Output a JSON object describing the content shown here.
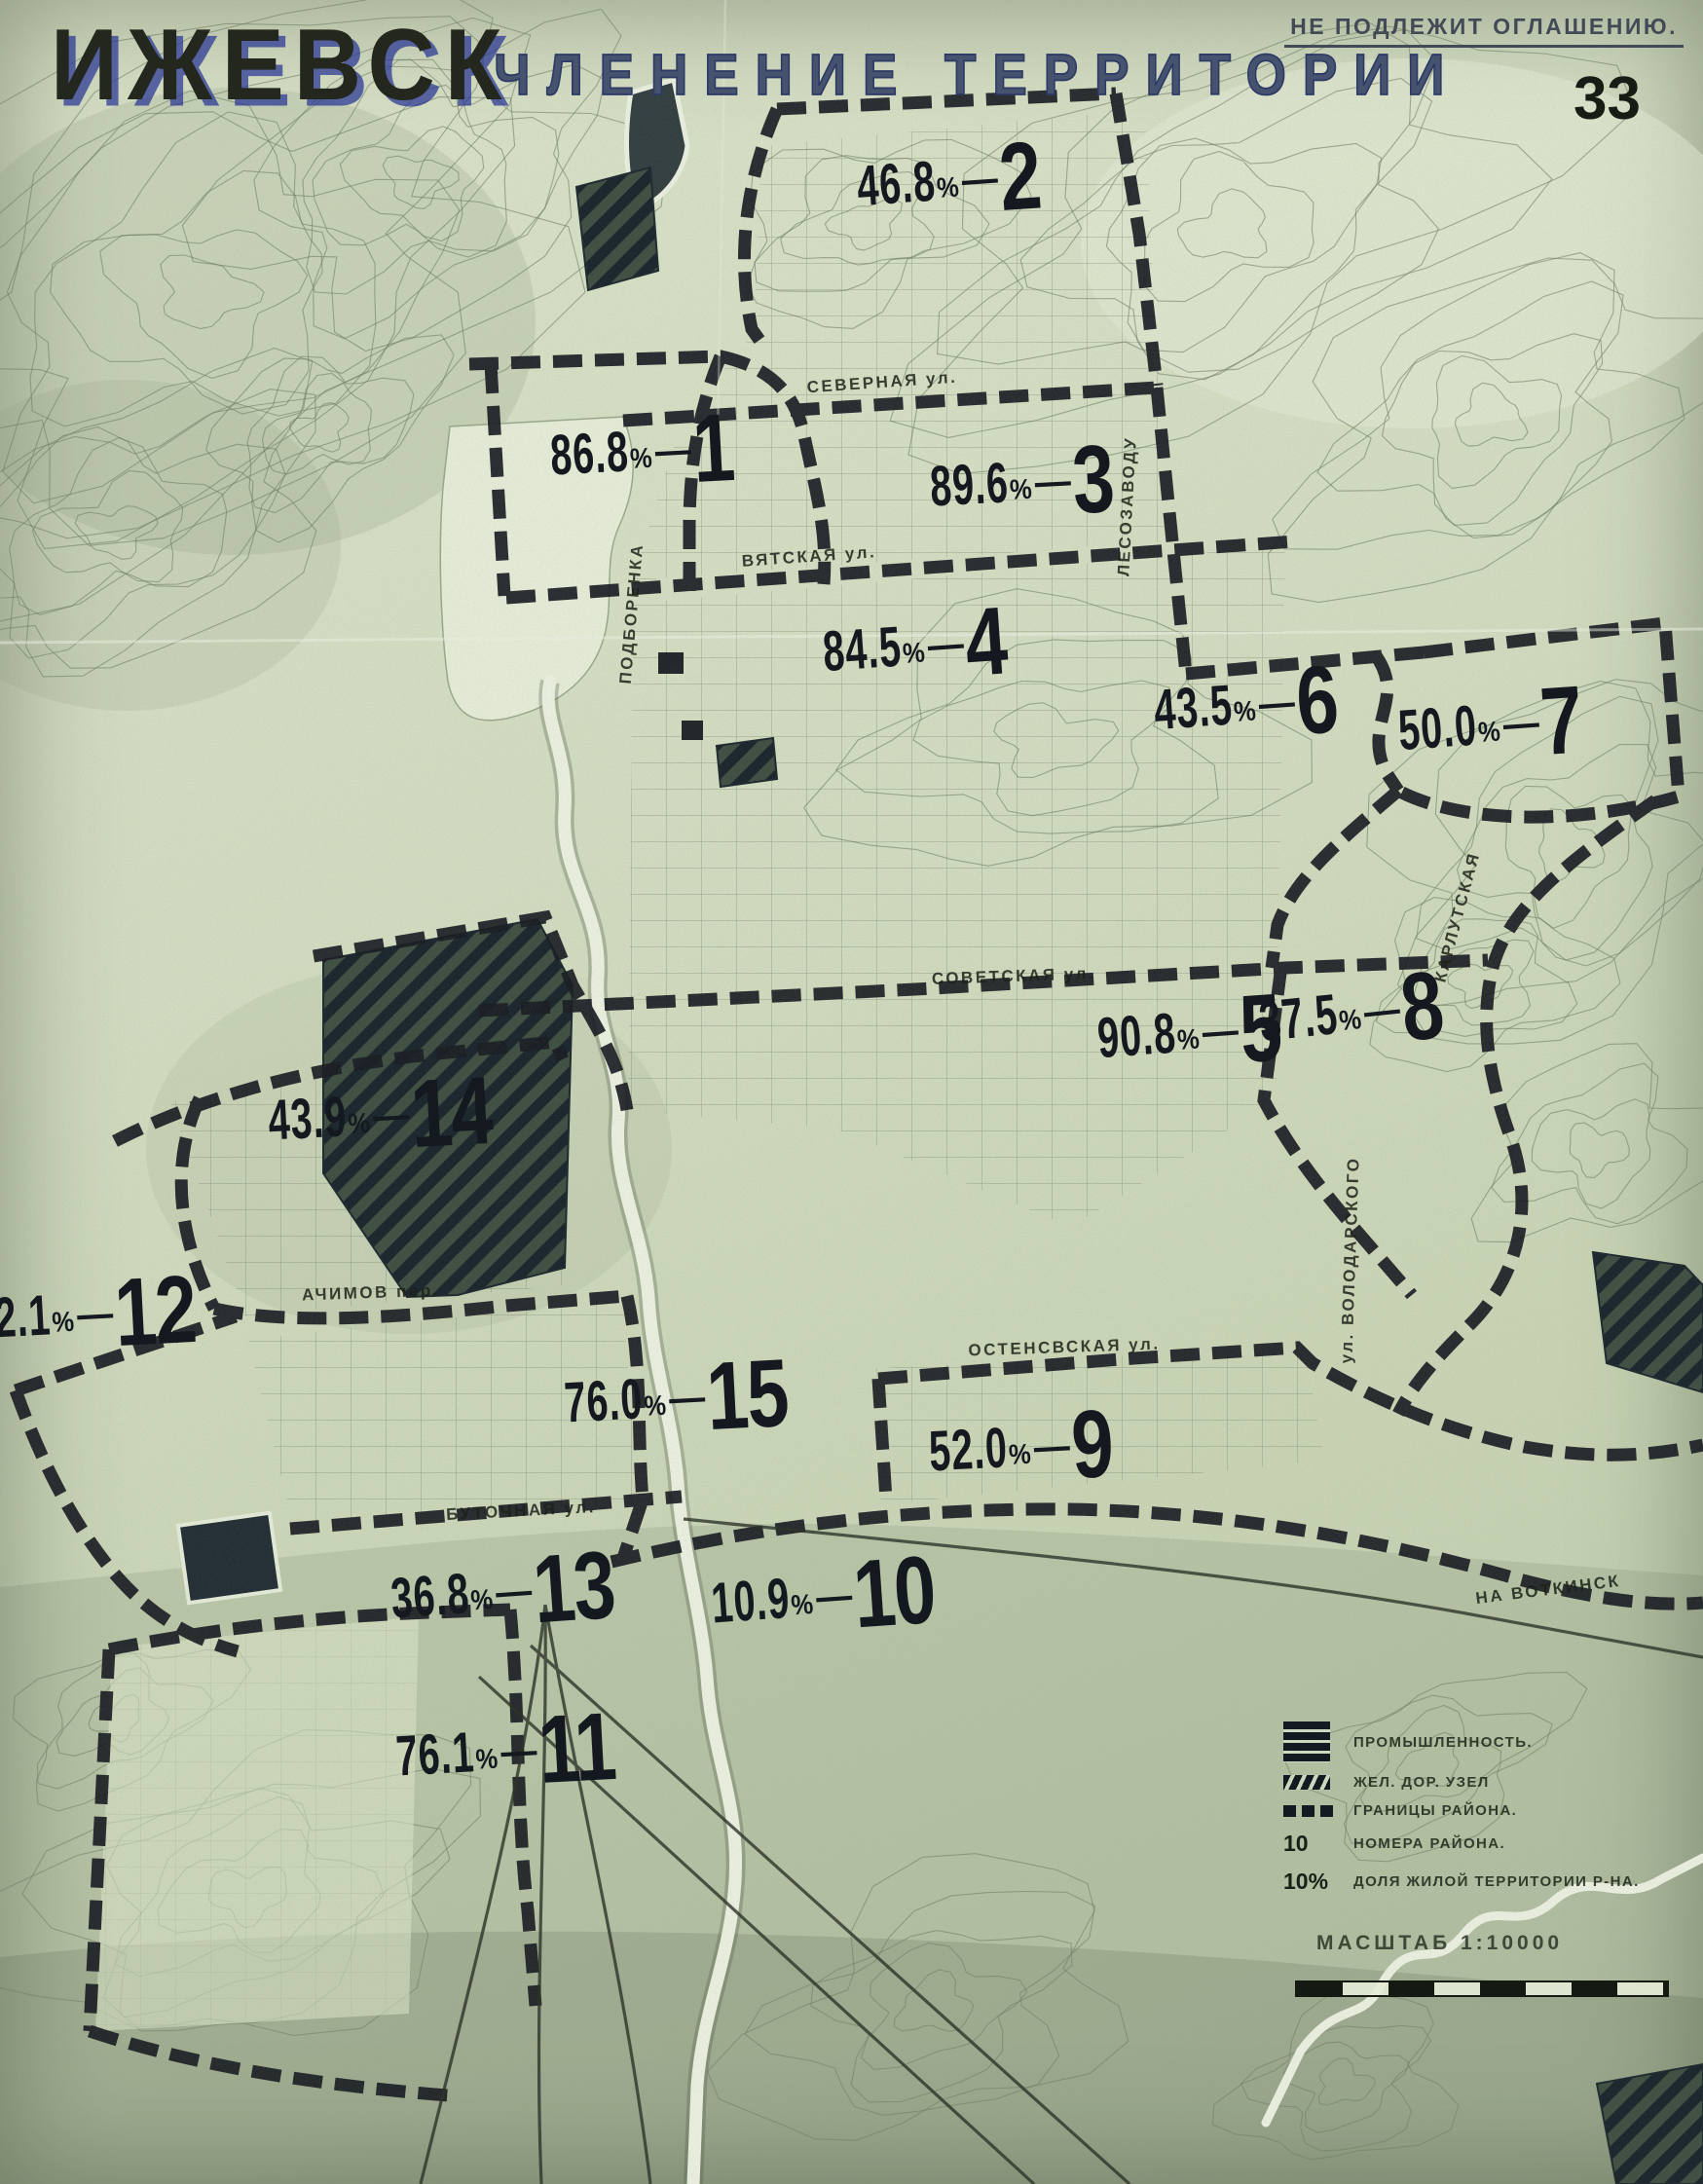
{
  "header": {
    "title": "ИЖЕВСК",
    "subtitle": "ЧЛЕНЕНИЕ ТЕРРИТОРИИ",
    "classification": "НЕ ПОДЛЕЖИТ ОГЛАШЕНИЮ.",
    "sheet_number": "33"
  },
  "districts": [
    {
      "number": "1",
      "share": "86.8%",
      "x": 37.7,
      "y": 20.7,
      "rot": -3
    },
    {
      "number": "2",
      "share": "46.8%",
      "x": 55.7,
      "y": 8.3,
      "rot": -4
    },
    {
      "number": "3",
      "share": "89.6%",
      "x": 60.0,
      "y": 22.1,
      "rot": -3
    },
    {
      "number": "4",
      "share": "84.5%",
      "x": 53.7,
      "y": 29.6,
      "rot": -4
    },
    {
      "number": "5",
      "share": "90.8%",
      "x": 69.8,
      "y": 47.3,
      "rot": -4
    },
    {
      "number": "6",
      "share": "43.5%",
      "x": 73.1,
      "y": 32.3,
      "rot": -4
    },
    {
      "number": "7",
      "share": "50.0%",
      "x": 87.5,
      "y": 33.2,
      "rot": -4
    },
    {
      "number": "8",
      "share": "37.5%",
      "x": 79.3,
      "y": 46.4,
      "rot": -6
    },
    {
      "number": "9",
      "share": "52.0%",
      "x": 59.9,
      "y": 66.3,
      "rot": -3
    },
    {
      "number": "10",
      "share": "10.9%",
      "x": 48.3,
      "y": 73.1,
      "rot": -4
    },
    {
      "number": "11",
      "share": "76.1%",
      "x": 29.7,
      "y": 80.2,
      "rot": -3
    },
    {
      "number": "12",
      "share": "42.1%",
      "x": 4.9,
      "y": 60.2,
      "rot": -3
    },
    {
      "number": "13",
      "share": "36.8%",
      "x": 29.5,
      "y": 72.9,
      "rot": -4
    },
    {
      "number": "14",
      "share": "43.9%",
      "x": 22.3,
      "y": 51.1,
      "rot": -3
    },
    {
      "number": "15",
      "share": "76.0%",
      "x": 39.7,
      "y": 64.0,
      "rot": -3
    }
  ],
  "streets": [
    {
      "name": "СЕВЕРНАЯ ул.",
      "x": 51.8,
      "y": 17.5,
      "rot": -4
    },
    {
      "name": "ВЯТСКАЯ ул.",
      "x": 47.5,
      "y": 25.5,
      "rot": -4
    },
    {
      "name": "СОВЕТСКАЯ ул.",
      "x": 59.5,
      "y": 44.7,
      "rot": -2
    },
    {
      "name": "ОСТЕНСВСКАЯ ул.",
      "x": 62.5,
      "y": 61.7,
      "rot": -2
    },
    {
      "name": "АЧИМОВ пер.",
      "x": 21.8,
      "y": 59.2,
      "rot": -2
    },
    {
      "name": "БУТОЧНАЯ ул.",
      "x": 30.6,
      "y": 69.2,
      "rot": -3
    },
    {
      "name": "НА ВОТКИНСК",
      "x": 90.9,
      "y": 72.8,
      "rot": -7
    },
    {
      "name": "ПОДБОРЕНКА",
      "x": 37.1,
      "y": 28.1,
      "rot": -85
    },
    {
      "name": "ЛЕСОЗАВОДУ",
      "x": 66.2,
      "y": 23.2,
      "rot": -87
    },
    {
      "name": "ул. ВОЛОДАРСКОГО",
      "x": 79.3,
      "y": 57.7,
      "rot": -88
    },
    {
      "name": "КАРЛУТСКАЯ",
      "x": 85.6,
      "y": 42.0,
      "rot": -75
    }
  ],
  "legend": {
    "items": [
      {
        "key": "industry",
        "symbol_text": "",
        "label": "ПРОМЫШЛЕННОСТЬ."
      },
      {
        "key": "railway",
        "symbol_text": "",
        "label": "ЖЕЛ. ДОР. УЗЕЛ"
      },
      {
        "key": "boundary",
        "symbol_text": "",
        "label": "ГРАНИЦЫ РАЙОНА."
      },
      {
        "key": "number",
        "symbol_text": "10",
        "label": "НОМЕРА РАЙОНА."
      },
      {
        "key": "share",
        "symbol_text": "10%",
        "label": "ДОЛЯ ЖИЛОЙ ТЕРРИТОРИИ Р-НА."
      }
    ],
    "scale_label": "МАСШТАБ 1:10000"
  },
  "colors": {
    "paper": "#d6e0c6",
    "ink": "#141920",
    "accent_blue": "#2e3a72",
    "contour": "#6f7e66"
  }
}
